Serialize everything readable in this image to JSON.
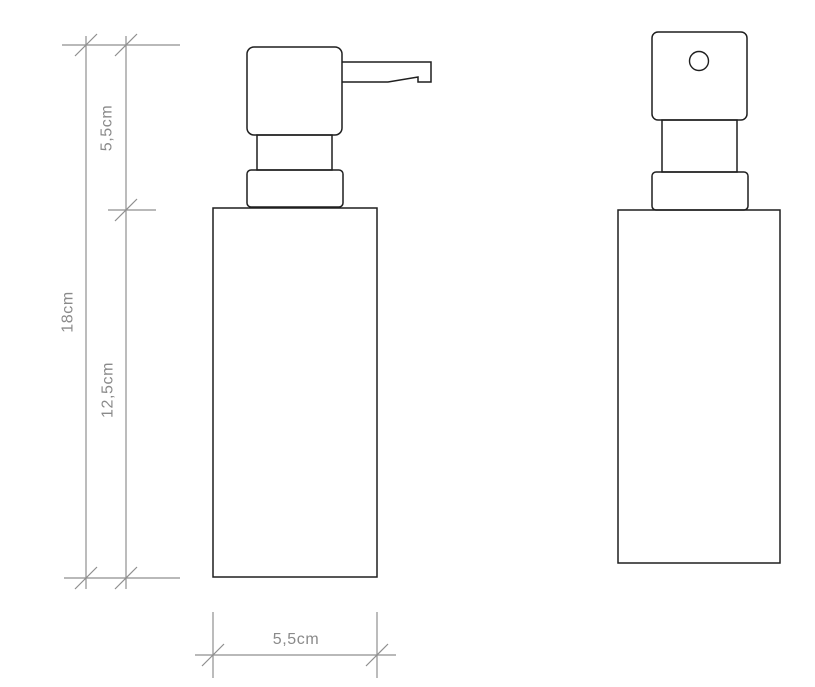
{
  "drawing": {
    "dimensions": {
      "upper_height": {
        "label": "5,5cm",
        "measures": "pump section height"
      },
      "total_height": {
        "label": "18cm",
        "measures": "overall height"
      },
      "body_height": {
        "label": "12,5cm",
        "measures": "body height"
      },
      "body_width": {
        "label": "5,5cm",
        "measures": "body width"
      }
    },
    "colors": {
      "outline": "#1f1f1f",
      "dimension_line": "#8f8f8f",
      "label_text": "#8a8a8a",
      "background": "#ffffff"
    }
  }
}
